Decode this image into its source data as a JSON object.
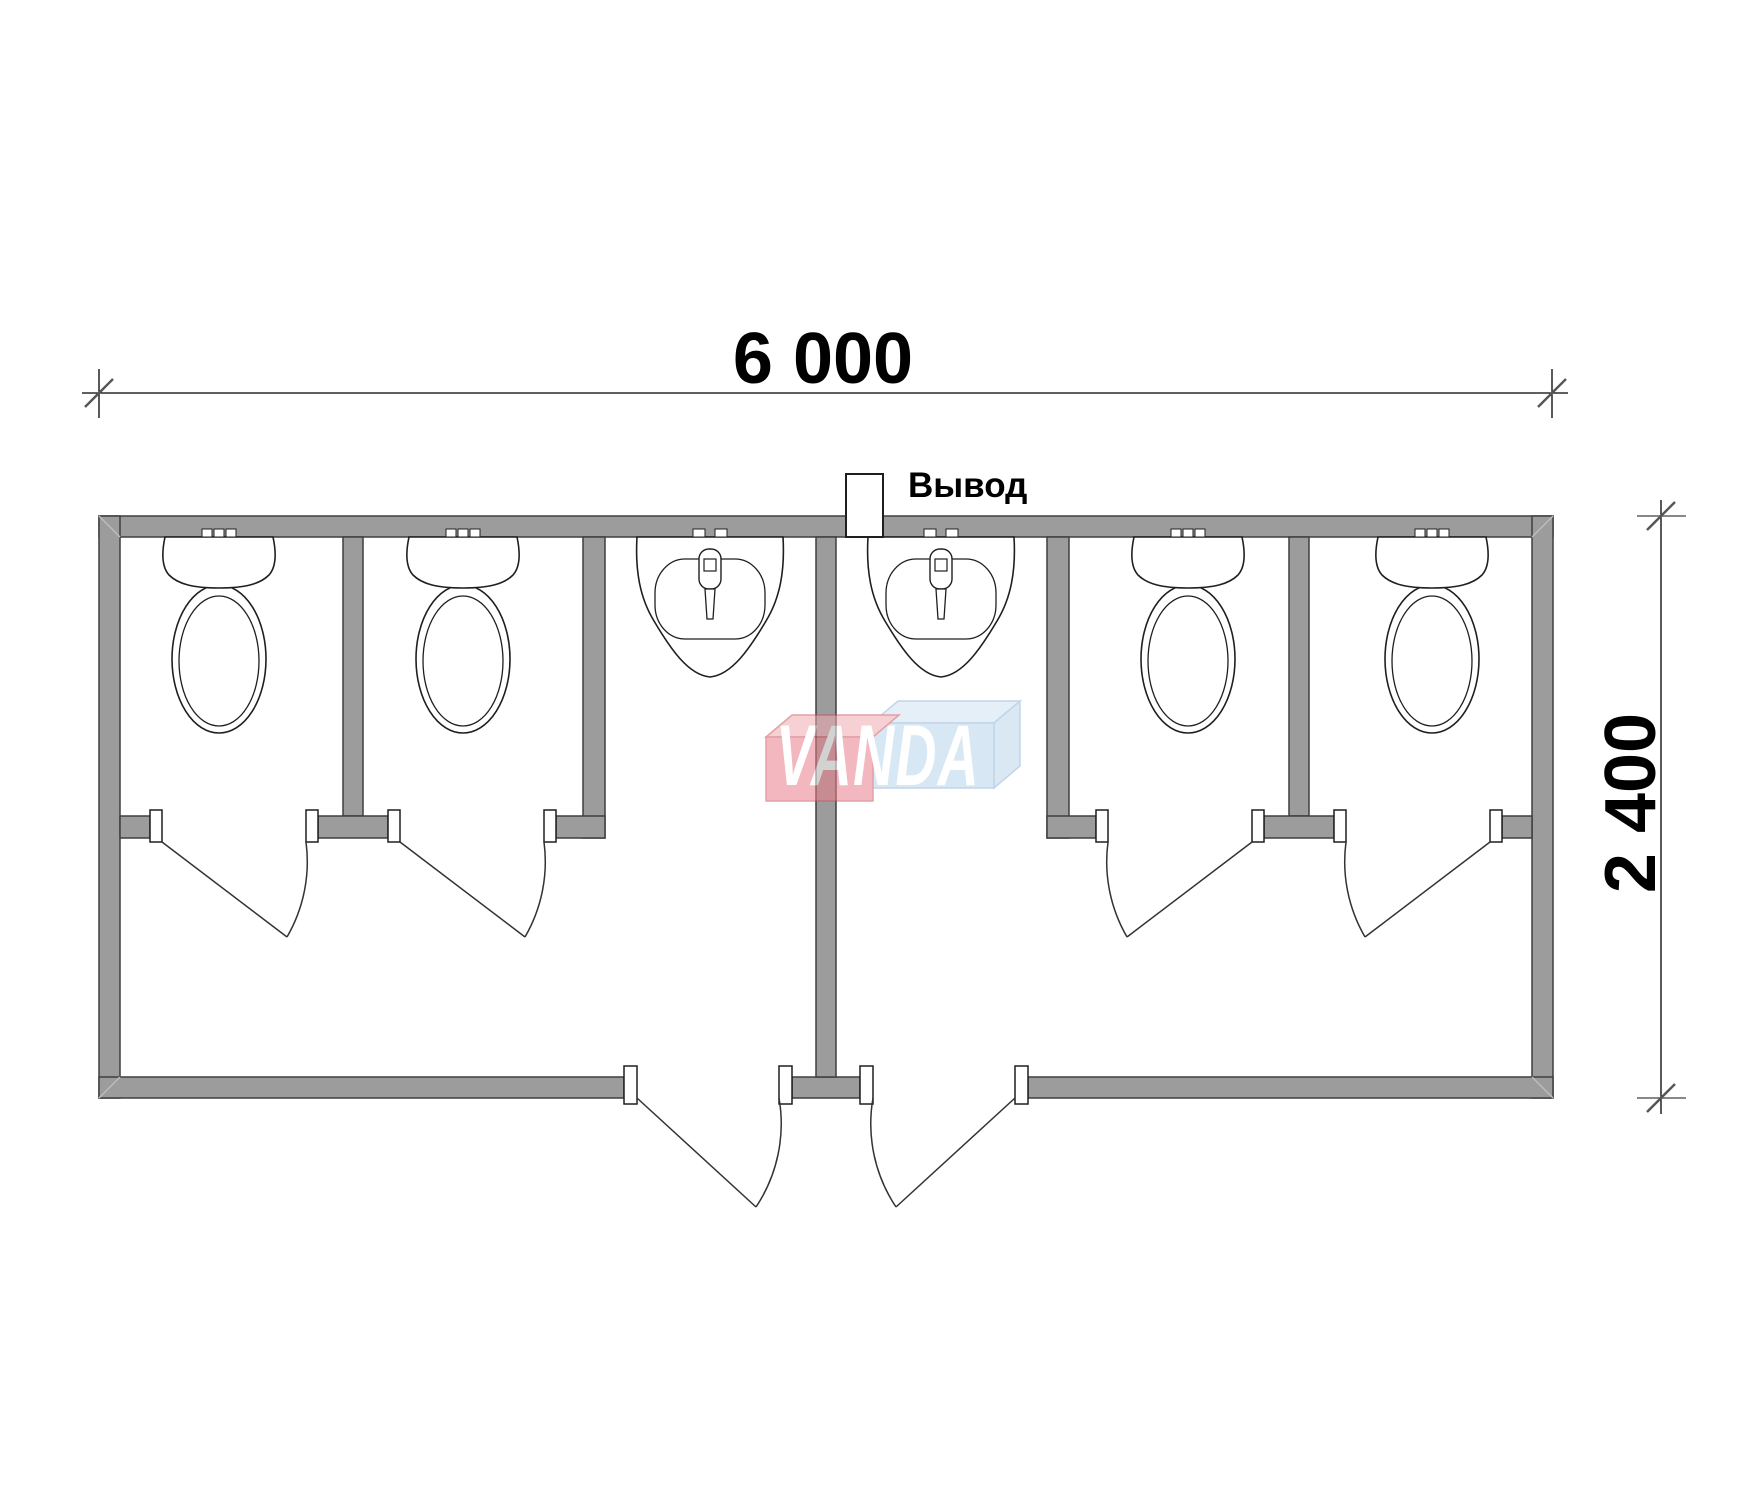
{
  "drawing": {
    "type": "floor-plan",
    "description": "Plan of modular sanitary container with 4 toilet stalls, 2 wash rooms with sinks, 2 entrance doors"
  },
  "dimensions": {
    "width_label": "6 000",
    "height_label": "2 400"
  },
  "labels": {
    "outlet": "Вывод"
  },
  "watermark": {
    "text": "VANDA",
    "red_box_color": "#ea7f8b",
    "blue_box_color": "#b7d4ec"
  },
  "colors": {
    "wall_fill": "#9c9c9c",
    "wall_outline": "#3f3f3f",
    "fixture_line": "#1f1f1f",
    "background": "#ffffff"
  },
  "fixtures": {
    "toilet_count": 4,
    "sink_count": 2,
    "stall_door_count": 4,
    "entrance_door_count": 2,
    "outlet_count": 1
  }
}
